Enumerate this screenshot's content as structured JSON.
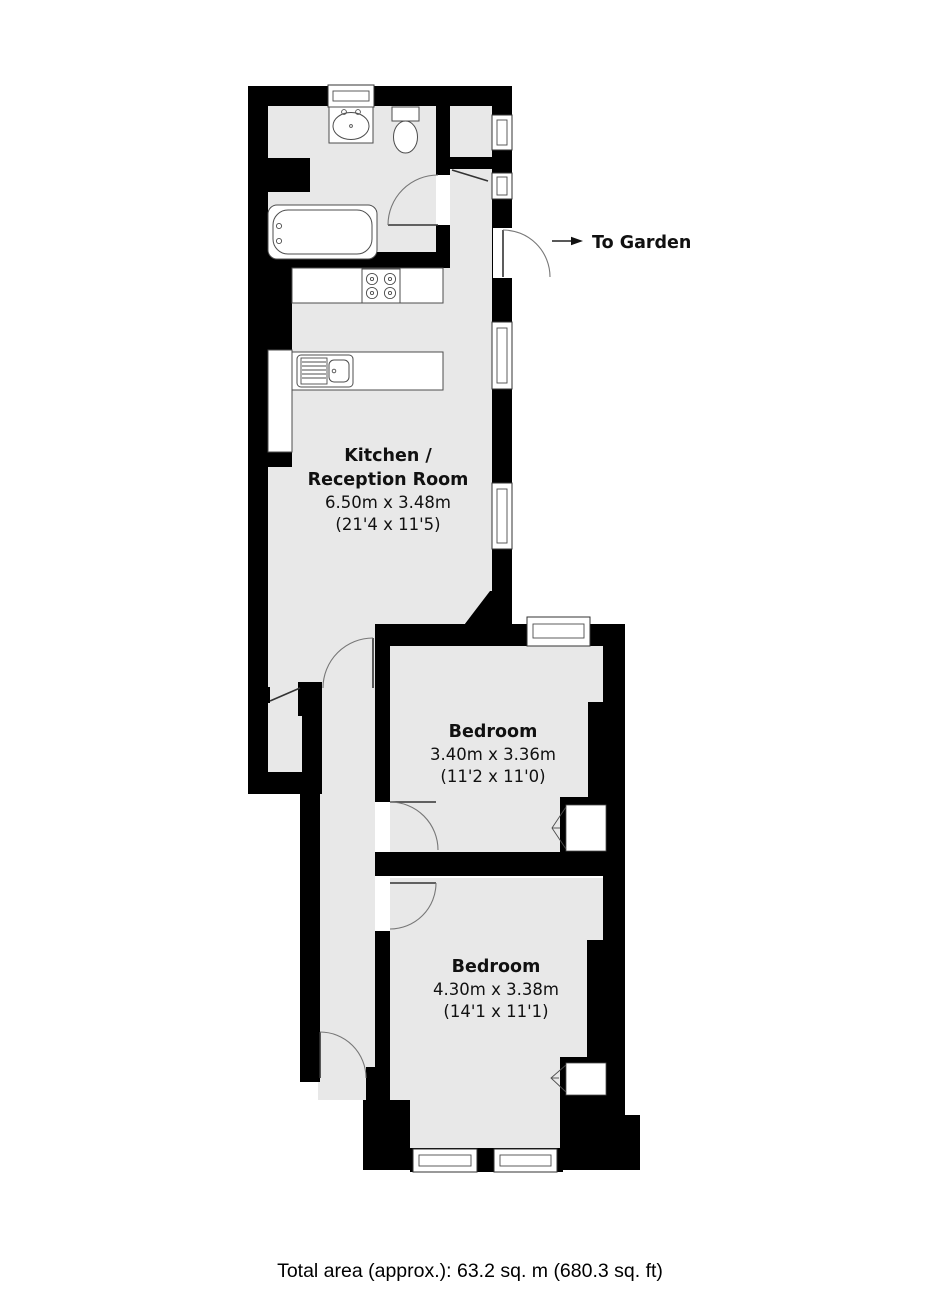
{
  "plan": {
    "type": "floorplan",
    "garden": {
      "label": "To Garden"
    },
    "rooms": {
      "kitchen": {
        "line1": "Kitchen /",
        "line2": "Reception Room",
        "size_metric": "6.50m x 3.48m",
        "size_imperial": "(21'4 x 11'5)"
      },
      "bedroom1": {
        "name": "Bedroom",
        "size_metric": "3.40m x 3.36m",
        "size_imperial": "(11'2 x 11'0)"
      },
      "bedroom2": {
        "name": "Bedroom",
        "size_metric": "4.30m x 3.38m",
        "size_imperial": "(14'1 x 11'1)"
      }
    },
    "footer": {
      "total_area_label": "Total area (approx.): 63.2 sq. m (680.3 sq. ft)"
    },
    "colors": {
      "wall": "#000000",
      "floor": "#e8e8e8",
      "background": "#ffffff"
    }
  }
}
